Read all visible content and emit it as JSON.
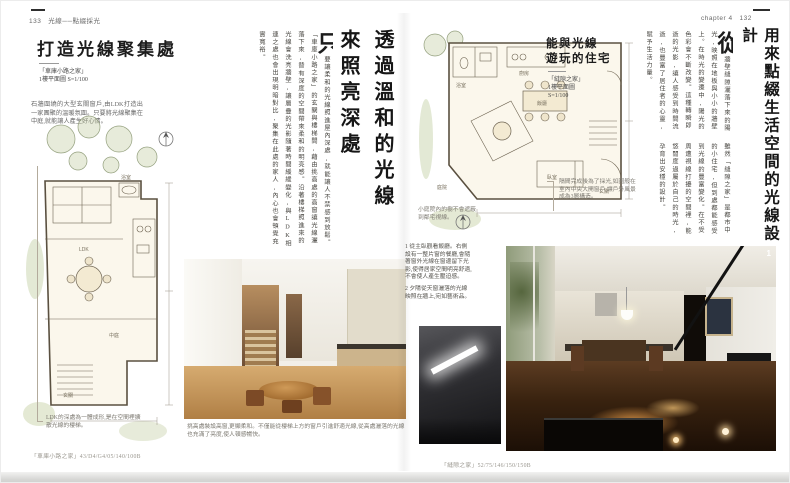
{
  "header": {
    "left_page_num": "133",
    "left_running_title": "光線──點綴採光",
    "chapter_label": "chapter 4",
    "right_page_num": "132"
  },
  "left_page": {
    "title": "打造光線聚集處",
    "plan_name": "「車庫小路之家」",
    "plan_scale": "1樓平面圖 S=1/100",
    "intro": "石牆圍繞的大型玄關窗戶,由LDK打造出一家團聚的溫暖氛圍。只要將光線聚集在中庭,就能讓人產生好心情。",
    "plan_note": "LDK的深處為一體成形,是在空間裡擴散光線的樓梯。",
    "plan_labels": [
      "LDK",
      "玄關",
      "中庭",
      "浴室"
    ],
    "photo_caption": "挑高處裝設高窗,更顯柔和。不僅能從樓梯上方的窗戶引進舒適光線,從高處灑落的光線也充滿了亮度,使人頓感暢快。",
    "footnote": "「車庫小路之家」43/D4/G4/05/140/100B"
  },
  "center": {
    "title_line1": "透過溫和的光線",
    "title_line2": "來照亮深處",
    "drop_cap": "只",
    "body": "要讓柔和的光線照進屋內深處,就能讓人不禁感到放鬆。「車庫小路之家」的玄關與樓梯間,藉由挑高處的高窗讓光線灑落下來,替有深度的空間帶來柔和的明亮感。沿著樓梯照進來的光線會洗亮牆壁,讓層疊的光影隨著時間緩緩變化,與LDK相連之處也會出現明暗對比,聚集在此處的家人,內心也會頓覺充實寬裕。"
  },
  "right_page": {
    "main_title": "用來點綴生活空間的光線設計",
    "drop_cap": "從",
    "para1": "牆壁縫隙灑落下來的陽光,映照在地板與小小的牆壁上。在時光的變遷中,陽光的色彩會不斷改變。這種轉瞬即逝的光影,讓人感受到時間流逝,也豐富了居住者的心靈,賦予生活力量。",
    "para2": "雖然「縫隙之家」是都市中的小住宅,但到處都能感受到光線的豐富變化。在不受周遭視線打擾的空間裡,能悠閒度過屬於自己的時光,孕育出安穩的設計。",
    "section_title_line1": "能與光線",
    "section_title_line2": "遊玩的住宅",
    "plan_name": "「縫隙之家」",
    "plan_scale_line1": "1樓平面圖",
    "plan_scale_line2": "S=1/100",
    "plan_note_right": "隔間完成後為了採光,如圖般在室內中央大開窗戶,讓戶外風景成為3層構造。",
    "plan_note_left": "小庭院內的樹不會遮蔽到鄰宅視線。",
    "plan_labels": [
      "浴室",
      "廚房",
      "飯廳",
      "臥室",
      "庭院",
      "玄關"
    ],
    "caption1": "1 從主臥觀看飯廳。右側設有一整片窗的餐廳,會隨著窗外光線在窗邊留下光影,使得居家空間明亮舒適,不會使人產生壓迫感。",
    "caption2": "2 夕陽從天窗灑落的光線映照在牆上,宛如藝術品。",
    "photo_badge": "1",
    "footnote": "「縫隙之家」52/75/146/150/150B"
  }
}
